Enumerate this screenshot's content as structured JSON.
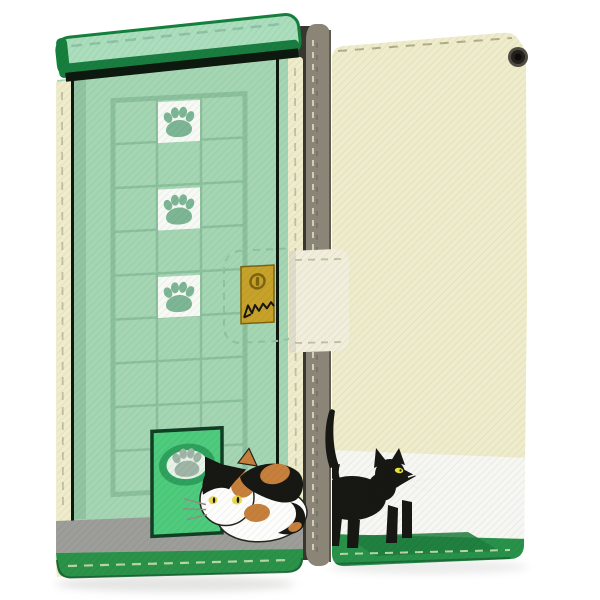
{
  "scene": {
    "type": "product-photo",
    "subject": "flip wallet smartphone case with cat design, shown closed from front (left) and back (right)",
    "views": [
      "front-closed",
      "back"
    ],
    "front_design": {
      "wall": "mint green with square lattice window",
      "paw_squares": 3,
      "lattice_columns": 3,
      "cat_door": "bright green door with oval paw emblem",
      "floor": "grey baseboard over green base",
      "cat": "calico cat crouching at the door"
    },
    "back_design": {
      "bands_top_to_bottom": [
        "cream",
        "white",
        "green"
      ],
      "cat": "black cat walking right with raised tail",
      "camera_opening": true
    },
    "clasp": {
      "strap": "cream strap wrapping right edge",
      "charm": "gold square with snap stud and black cat doodle"
    }
  },
  "colors": {
    "mint_body": "#a5d6b3",
    "mint_flap": "#abdebd",
    "flap_border": "#15803c",
    "flap_underband": "#1a7d40",
    "under_shadow": "#0d180f",
    "lattice": "#8cc09d",
    "shade_strip": "#93c4a2",
    "square_white": "#f7f9f4",
    "paw_print": "#7db695",
    "door_green": "#4ecb7c",
    "door_frame": "#113f24",
    "door_ring": "#2ea25d",
    "door_inner": "#e7f2e8",
    "door_paw": "#9fb5a6",
    "grey_band": "#9d9d99",
    "base_green": "#2b9249",
    "base_green_dark": "#175c30",
    "cream": "#eeecca",
    "white_band": "#f6f6f2",
    "back_green": "#28924b",
    "spine": "#8b8578",
    "spine_edge": "#5f5b4f",
    "phone": "#38372f",
    "phone_button": "#5a594f",
    "strap": "#f1eedb",
    "gold": "#c7a22a",
    "gold_dark": "#7d6410",
    "cat_black": "#171714",
    "cat_white": "#fdfdfb",
    "cat_orange": "#c6803b",
    "eye_yellow": "#e8d84a",
    "eye_green_yellow": "#e6e23c",
    "whisker_white": "#f2f2ee",
    "whisker_grey": "#8f8f88",
    "outline": "#26251f",
    "stitch_cream": "#c3bfa0",
    "stitch_green": "#b7d6a2",
    "stitch_mint": "#8fc2a4",
    "stitch_spine": "#d9d5c4",
    "stitch_back_top": "#b2ad89",
    "cat_shadow": "#1f7d3d",
    "cam_outer": "#504c41",
    "cam_mid": "#23211b",
    "cam_hole": "#0e0d0a",
    "shadow_grey": "#cfcfcd"
  }
}
